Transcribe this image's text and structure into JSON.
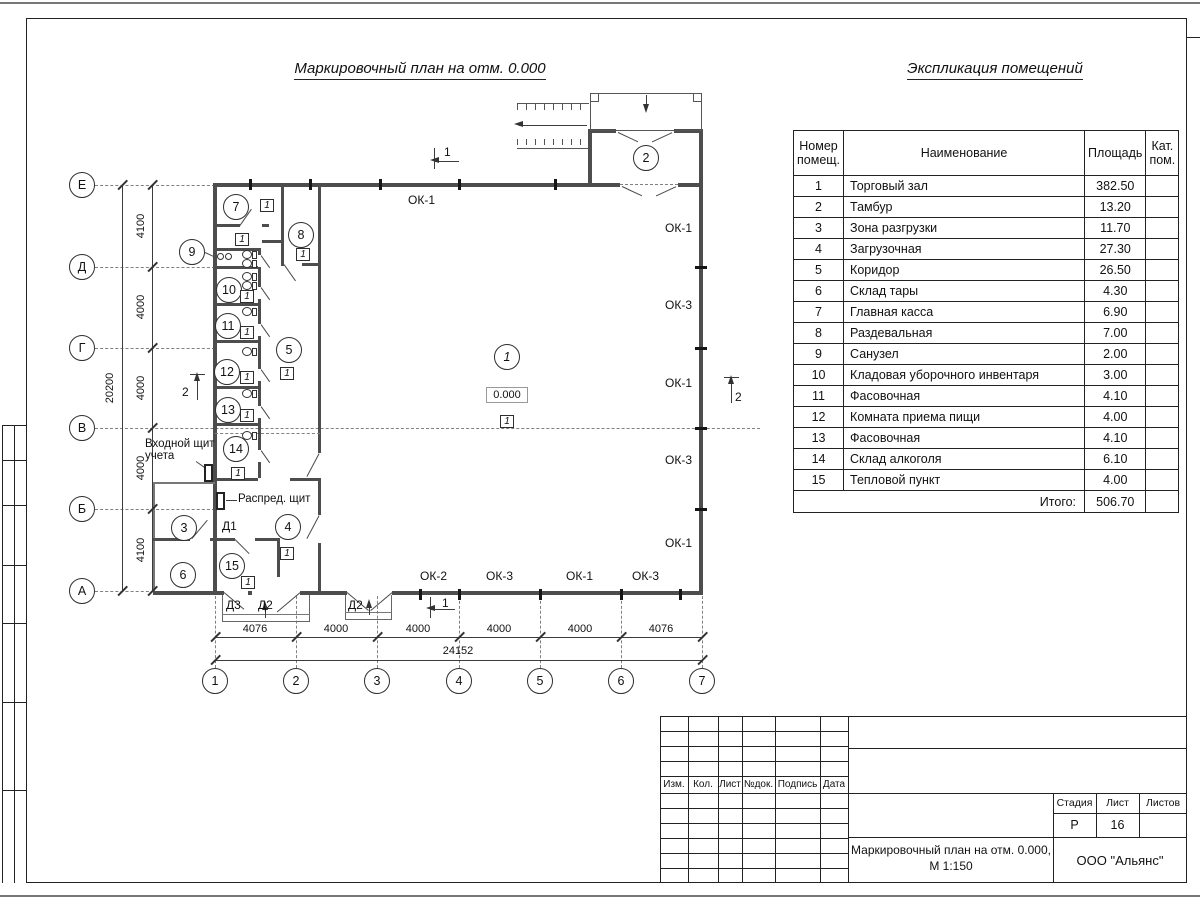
{
  "titles": {
    "plan": "Маркировочный план на отм. 0.000",
    "table": "Экспликация помещений"
  },
  "table": {
    "header_num": "Номер помещ.",
    "header_name": "Наименование",
    "header_area": "Площадь",
    "header_cat": "Кат. пом.",
    "rows": [
      {
        "n": "1",
        "name": "Торговый зал",
        "area": "382.50"
      },
      {
        "n": "2",
        "name": "Тамбур",
        "area": "13.20"
      },
      {
        "n": "3",
        "name": "Зона разгрузки",
        "area": "11.70"
      },
      {
        "n": "4",
        "name": "Загрузочная",
        "area": "27.30"
      },
      {
        "n": "5",
        "name": "Коридор",
        "area": "26.50"
      },
      {
        "n": "6",
        "name": "Склад тары",
        "area": "4.30"
      },
      {
        "n": "7",
        "name": "Главная касса",
        "area": "6.90"
      },
      {
        "n": "8",
        "name": "Раздевальная",
        "area": "7.00"
      },
      {
        "n": "9",
        "name": "Санузел",
        "area": "2.00"
      },
      {
        "n": "10",
        "name": "Кладовая уборочного инвентаря",
        "area": "3.00"
      },
      {
        "n": "11",
        "name": "Фасовочная",
        "area": "4.10"
      },
      {
        "n": "12",
        "name": "Комната приема пищи",
        "area": "4.00"
      },
      {
        "n": "13",
        "name": "Фасовочная",
        "area": "4.10"
      },
      {
        "n": "14",
        "name": "Склад алкоголя",
        "area": "6.10"
      },
      {
        "n": "15",
        "name": "Тепловой пункт",
        "area": "4.00"
      }
    ],
    "total_label": "Итого:",
    "total_value": "506.70"
  },
  "plan": {
    "rooms": [
      "1",
      "2",
      "3",
      "4",
      "5",
      "6",
      "7",
      "8",
      "9",
      "10",
      "11",
      "12",
      "13",
      "14",
      "15"
    ],
    "axis_rows": [
      "Е",
      "Д",
      "Г",
      "В",
      "Б",
      "А"
    ],
    "axis_cols": [
      "1",
      "2",
      "3",
      "4",
      "5",
      "6",
      "7"
    ],
    "dims_left": [
      "4100",
      "4000",
      "4000",
      "4000",
      "4100"
    ],
    "dims_left_total": "20200",
    "dims_bottom": [
      "4076",
      "4000",
      "4000",
      "4000",
      "4000",
      "4076"
    ],
    "dims_bottom_total": "24152",
    "window_top": "ОК-1",
    "windows_right": [
      "ОК-1",
      "ОК-3",
      "ОК-1",
      "ОК-3",
      "ОК-1"
    ],
    "windows_bottom": [
      "ОК-2",
      "ОК-3",
      "ОК-1",
      "ОК-3"
    ],
    "elevation": "0.000",
    "floor_mark": "1",
    "entry_panel_line1": "Входной щит",
    "entry_panel_line2": "учета",
    "distribution_panel": "Распред. щит",
    "door_d1": "Д1",
    "door_d2": "Д2",
    "door_d3": "Д3",
    "section_1": "1",
    "section_2": "2"
  },
  "titleblock": {
    "cols": [
      "Изм.",
      "Кол.",
      "Лист",
      "№док.",
      "Подпись",
      "Дата"
    ],
    "stage_label": "Стадия",
    "sheet_label": "Лист",
    "sheets_label": "Листов",
    "stage": "Р",
    "sheet": "16",
    "doc_title_line1": "Маркировочный план на отм. 0.000,",
    "doc_title_line2": "М 1:150",
    "company": "ООО \"Альянс\""
  }
}
